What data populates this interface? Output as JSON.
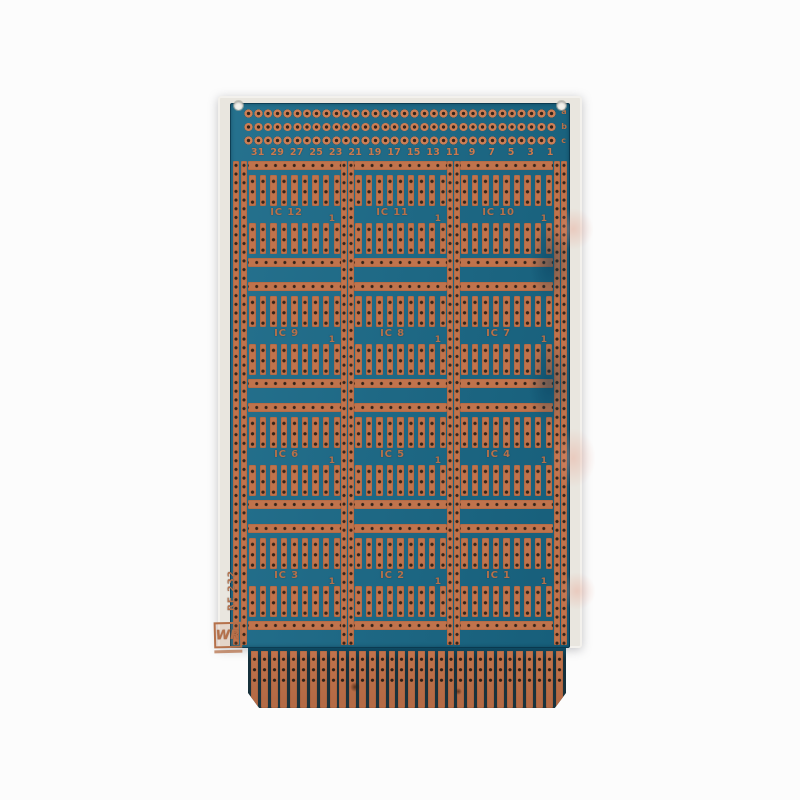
{
  "board": {
    "numbers": [
      "31",
      "29",
      "27",
      "25",
      "23",
      "21",
      "19",
      "17",
      "15",
      "13",
      "11",
      "9",
      "7",
      "5",
      "3",
      "1"
    ],
    "connector_row_labels": [
      "a",
      "b",
      "c"
    ],
    "ic_rows": [
      [
        "IC 12",
        "IC 11",
        "IC 10"
      ],
      [
        "IC 9",
        "IC 8",
        "IC 7"
      ],
      [
        "IC 6",
        "IC 5",
        "IC 4"
      ],
      [
        "IC 3",
        "IC 2",
        "IC 1"
      ]
    ],
    "pin1_marker": "1",
    "side_text": "RE 232",
    "logo_text": "WR",
    "counts": {
      "pad_rows": 3,
      "pads_per_row": 32,
      "ic_columns": 3,
      "ic_rows": 4,
      "strips_per_ic": 9,
      "bus_strips_side": 2,
      "bus_strips_separator": 2,
      "edge_fingers": 32
    },
    "colors": {
      "copper": "#c0734c",
      "copper_bright": "#cc7e55",
      "mask_teal": "#1a6a88",
      "mask_dark": "#14566f",
      "hole_dark": "#33241b",
      "substrate_cream": "#e9e6df",
      "label_copper": "#b5714b",
      "number_copper": "#c97a4f",
      "background": "#fcfcfc"
    }
  }
}
